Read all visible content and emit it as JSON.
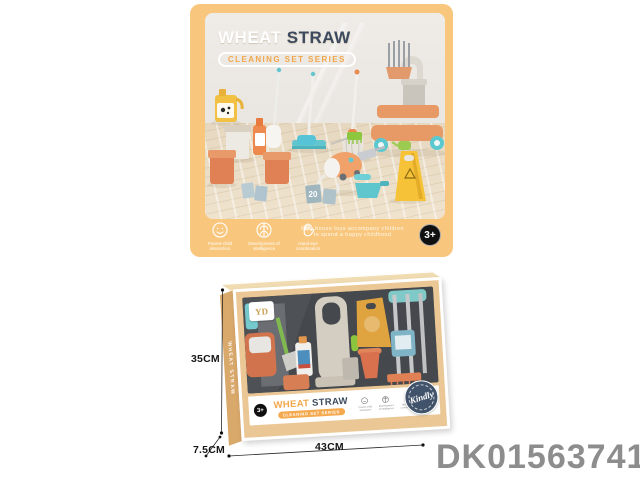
{
  "colors": {
    "card_background": "#F8C77D",
    "title_navy": "#3D4A5E",
    "accent_orange": "#F2A649",
    "box_frame_tan": "#EAC794",
    "stamp_navy": "#41536B",
    "product_code_gray": "#8D8D8D"
  },
  "top_card": {
    "title_part1": "WHEAT",
    "title_part2": "STRAW",
    "subtitle": "CLEANING SET SERIES",
    "tagline": "Play house toys accompany children to spend a happy childhood",
    "age_badge": "3+",
    "features": [
      {
        "icon": "parent-child-icon",
        "label": "Parent-child interaction"
      },
      {
        "icon": "intelligence-icon",
        "label": "Development of intelligence"
      },
      {
        "icon": "hand-eye-icon",
        "label": "Hand-eye coordination"
      }
    ],
    "scene": {
      "card_number": "20"
    }
  },
  "package_box": {
    "logo_text": "YD",
    "side_text": "WHEAT STRAW",
    "age_badge": "3+",
    "title_part1": "WHEAT",
    "title_part2": "STRAW",
    "subtitle": "CLEANING SET SERIES",
    "stamp_text": "Kindly",
    "features": [
      {
        "icon": "parent-child-icon",
        "label": "Parent-child interaction"
      },
      {
        "icon": "intelligence-icon",
        "label": "Development of intelligence"
      },
      {
        "icon": "hand-eye-icon",
        "label": "Hand-eye coordination"
      }
    ],
    "dims": {
      "height": "35CM",
      "width": "43CM",
      "depth": "7.5CM"
    }
  },
  "product_code": "DK01563741"
}
